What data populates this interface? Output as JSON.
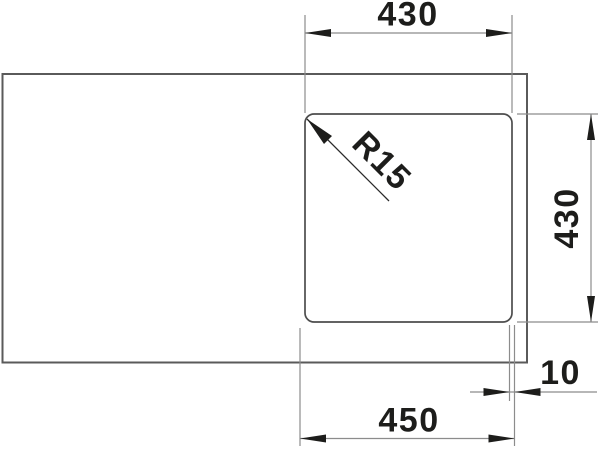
{
  "technical_drawing": {
    "dimensions": {
      "top_width": "430",
      "right_height": "430",
      "corner_radius": "R15",
      "edge_offset": "10",
      "bottom_width": "450"
    },
    "colors": {
      "outline": "#5a5a5a",
      "cutout_outline": "#4d4d4d",
      "dimension_line": "#8c8c8c",
      "annotation": "#1d1d1b",
      "background": "#ffffff"
    }
  }
}
